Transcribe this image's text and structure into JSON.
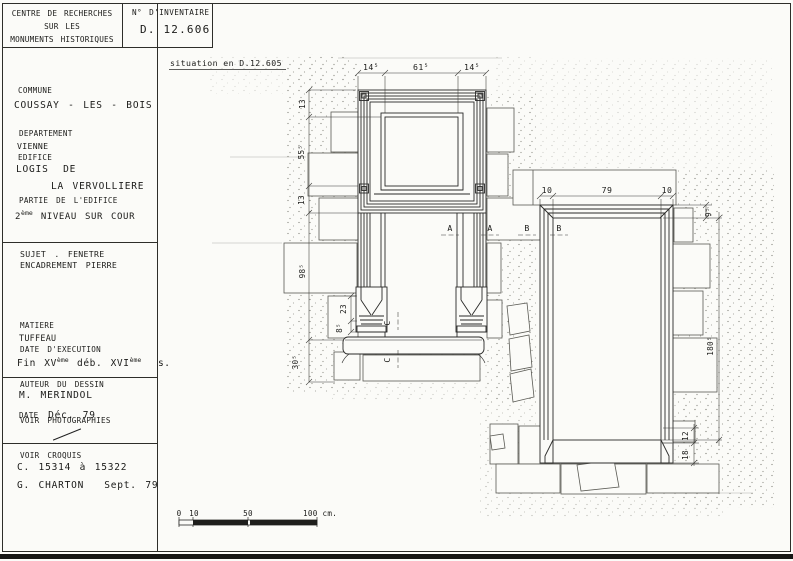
{
  "header": {
    "org_line1": "CENTRE DE RECHERCHES",
    "org_line2": "SUR LES",
    "org_line3": "MONUMENTS HISTORIQUES",
    "inventory_label": "N° D'INVENTAIRE",
    "inventory_number": "D. 12.606"
  },
  "sidebar": {
    "commune_label": "COMMUNE",
    "commune_value": "COUSSAY - LES - BOIS",
    "departement_label": "DEPARTEMENT",
    "departement_value": "VIENNE",
    "edifice_label": "EDIFICE",
    "edifice_value_line1": "LOGIS DE",
    "edifice_value_line2": "LA VERVOLLIERE",
    "partie_label": "PARTIE DE L'EDIFICE",
    "partie_num": "2",
    "partie_sup": "ème",
    "partie_rest": "NIVEAU SUR COUR",
    "sujet_line1": "SUJET . FENETRE",
    "sujet_line2": "ENCADREMENT PIERRE",
    "matiere_label": "MATIERE",
    "matiere_value": "TUFFEAU",
    "date_execution_label": "DATE D'EXECUTION",
    "date_exec_p1": "Fin XV",
    "date_exec_s1": "ème",
    "date_exec_p2": "déb. XVI",
    "date_exec_s2": "ème",
    "date_exec_p3": "s.",
    "auteur_label": "AUTEUR DU DESSIN",
    "auteur_value": "M. MERINDOL",
    "date_label": "DATE",
    "date_value": "Déc. 79",
    "voir_photographies": "VOIR PHOTOGRAPHIES",
    "voir_croquis_label": "VOIR CROQUIS",
    "croquis_refs": "C. 15314 à 15322",
    "surveyor_name": "G. CHARTON",
    "surveyor_date": "Sept. 79"
  },
  "drawing": {
    "situation_note": "situation en D.12.605",
    "left_window": {
      "top_dims": {
        "left": "14⁵",
        "center": "61⁵",
        "right": "14⁵"
      },
      "side_dims": {
        "lintel": "13",
        "upper_opening": "55⁵",
        "transom": "13",
        "lower_opening": "98⁵",
        "sill_zone": "30⁵",
        "base": "23",
        "foot": "8⁵"
      },
      "section_label_a": "A",
      "section_label_c": "C"
    },
    "right_window": {
      "top_dims": {
        "left": "10",
        "center": "79",
        "right": "10"
      },
      "side_dims": {
        "lintel": "9⁵",
        "opening_height": "180⁵",
        "chamfer_stop": "12",
        "foot": "18"
      },
      "section_label_b": "B"
    },
    "scale_bar": {
      "tick_0": "0",
      "tick_10": "10",
      "tick_50": "50",
      "tick_100": "100 cm."
    }
  }
}
